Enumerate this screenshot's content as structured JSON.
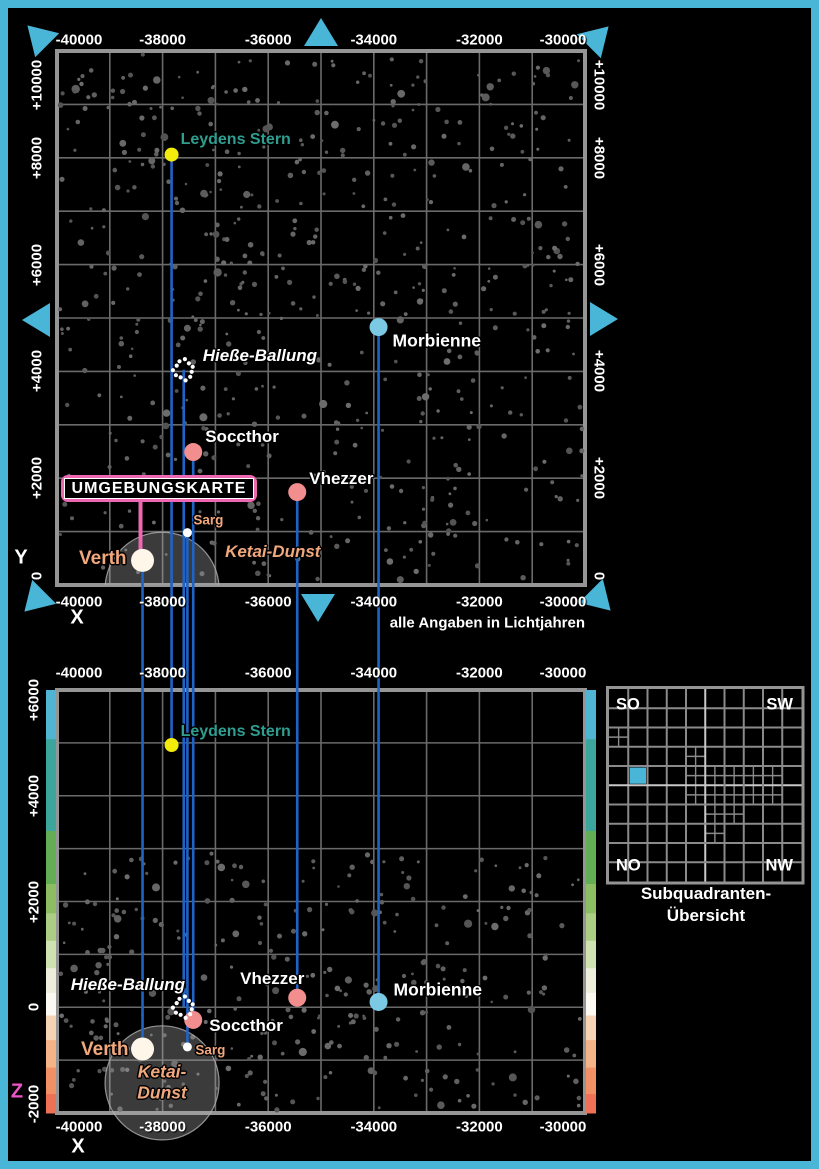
{
  "page": {
    "background": "#000000",
    "frame_color": "#4ab6d7"
  },
  "footnote": "alle Angaben in Lichtjahren",
  "center_box": {
    "label": "UMGEBUNGSKARTE",
    "border_color": "#ee67b2"
  },
  "axes": {
    "x_label": "X",
    "y_label": "Y",
    "z_label": "Z",
    "z_label_color": "#ee55c9",
    "x_ticks": [
      "-40000",
      "-38000",
      "-36000",
      "-34000",
      "-32000",
      "-30000"
    ],
    "y_ticks": [
      "+10000",
      "+8000",
      "+6000",
      "+4000",
      "+2000",
      "0"
    ],
    "z_ticks": [
      "+6000",
      "+4000",
      "+2000",
      "0",
      "-2000"
    ]
  },
  "colors": {
    "grid": "#6a6a6a",
    "map_border": "#959595",
    "drop_line": "#2063c6",
    "pointer_line": "#ee67b2",
    "accent": "#4ab6d7",
    "teal_label": "#2f9e90",
    "salmon_label": "#f2a87d",
    "nebula_fill": "rgba(170,170,170,0.35)",
    "nebula_rim": "#b0b0b0",
    "starfield": "#5e5e5e"
  },
  "stars": [
    {
      "name": "Verth",
      "x": -38380,
      "y": 460,
      "z": -790,
      "kind": "star",
      "color": "#fdf6e9",
      "radius": 11.5,
      "label_color": "#f2a87d",
      "font_size": 19,
      "italic": false,
      "top_label": {
        "dx": -16,
        "dy": -1,
        "anchor": "end"
      },
      "bottom_label": {
        "dx": -14,
        "dy": 1,
        "anchor": "end"
      }
    },
    {
      "name": "Sarg",
      "x": -37530,
      "y": 980,
      "z": -750,
      "kind": "star",
      "color": "#ffffff",
      "radius": 4.5,
      "label_color": "#f2a87d",
      "font_size": 13.5,
      "italic": false,
      "top_label": {
        "dx": 6,
        "dy": -13,
        "anchor": "start"
      },
      "bottom_label": {
        "dx": 8,
        "dy": 3,
        "anchor": "start"
      }
    },
    {
      "name": "Soccthor",
      "x": -37420,
      "y": 2490,
      "z": -240,
      "kind": "star",
      "color": "#f28e8e",
      "radius": 9,
      "label_color": "#ffffff",
      "font_size": 17,
      "italic": false,
      "top_label": {
        "dx": 12,
        "dy": -15,
        "anchor": "start"
      },
      "bottom_label": {
        "dx": 16,
        "dy": 6,
        "anchor": "start"
      }
    },
    {
      "name": "Vhezzer",
      "x": -35450,
      "y": 1740,
      "z": 180,
      "kind": "star",
      "color": "#f28e8e",
      "radius": 9,
      "label_color": "#ffffff",
      "font_size": 17,
      "italic": false,
      "top_label": {
        "dx": 12,
        "dy": -13,
        "anchor": "start"
      },
      "bottom_label": {
        "dx": -25,
        "dy": -19,
        "anchor": "middle"
      }
    },
    {
      "name": "Morbienne",
      "x": -33910,
      "y": 4830,
      "z": 100,
      "kind": "star",
      "color": "#7cc9e6",
      "radius": 9,
      "label_color": "#ffffff",
      "font_size": 17.5,
      "italic": false,
      "top_label": {
        "dx": 14,
        "dy": 14,
        "anchor": "start"
      },
      "bottom_label": {
        "dx": 15,
        "dy": -12,
        "anchor": "start"
      }
    },
    {
      "name": "Leydens Stern",
      "x": -37830,
      "y": 8060,
      "z": 4960,
      "kind": "star",
      "color": "#f3eb0b",
      "radius": 7,
      "label_color": "#2f9e90",
      "font_size": 16,
      "italic": false,
      "top_label": {
        "dx": 9,
        "dy": -15,
        "anchor": "start"
      },
      "bottom_label": {
        "dx": 9,
        "dy": -13,
        "anchor": "start"
      }
    },
    {
      "name": "Hieße-Ballung",
      "x": -37600,
      "y": 4030,
      "z": 0,
      "kind": "cluster",
      "color": "#ffffff",
      "radius": 9.5,
      "label_color": "#ffffff",
      "font_size": 17,
      "italic": true,
      "top_label": {
        "dx": 19,
        "dy": -14,
        "anchor": "start"
      },
      "bottom_label": {
        "dx": -113,
        "dy": -22,
        "anchor": "start"
      }
    }
  ],
  "nebula": {
    "name": "Ketai-Dunst",
    "top_label": "Ketai-Dunst",
    "bottom_label_line1": "Ketai-",
    "bottom_label_line2": "Dunst",
    "x": -38010,
    "y": -80,
    "z": -1430,
    "radius_ly": 1080,
    "label_color": "#f2a87d",
    "font_size": 17
  },
  "z_scale": {
    "segments": [
      {
        "color": "#4fb5d3",
        "weight": 52
      },
      {
        "color": "#3ca69c",
        "weight": 97
      },
      {
        "color": "#63ae55",
        "weight": 56
      },
      {
        "color": "#8cbd63",
        "weight": 31
      },
      {
        "color": "#abcd84",
        "weight": 29
      },
      {
        "color": "#cfe2b2",
        "weight": 29
      },
      {
        "color": "#edeedb",
        "weight": 26
      },
      {
        "color": "#fbf9f1",
        "weight": 24
      },
      {
        "color": "#f7d3b5",
        "weight": 26
      },
      {
        "color": "#f5b388",
        "weight": 29
      },
      {
        "color": "#f19065",
        "weight": 28
      },
      {
        "color": "#ee7157",
        "weight": 20
      }
    ]
  },
  "overview": {
    "title_line1": "Subquadranten-",
    "title_line2": "Übersicht",
    "corner_tl": "SO",
    "corner_tr": "SW",
    "corner_bl": "NO",
    "corner_br": "NW",
    "grid_size": 10,
    "highlight_cell": {
      "col": 1,
      "row": 4
    },
    "highlight_color": "#4ab6d7",
    "subdivided_cells": [
      [
        0,
        2
      ],
      [
        4,
        3
      ],
      [
        4,
        4
      ],
      [
        5,
        4
      ],
      [
        6,
        4
      ],
      [
        7,
        4
      ],
      [
        8,
        4
      ],
      [
        4,
        5
      ],
      [
        5,
        5
      ],
      [
        6,
        5
      ],
      [
        7,
        5
      ],
      [
        8,
        5
      ],
      [
        5,
        6
      ],
      [
        6,
        6
      ],
      [
        5,
        7
      ]
    ]
  },
  "pan_arrows": [
    "up-left",
    "up",
    "up-right",
    "left",
    "right",
    "down-left",
    "down",
    "down-right"
  ]
}
